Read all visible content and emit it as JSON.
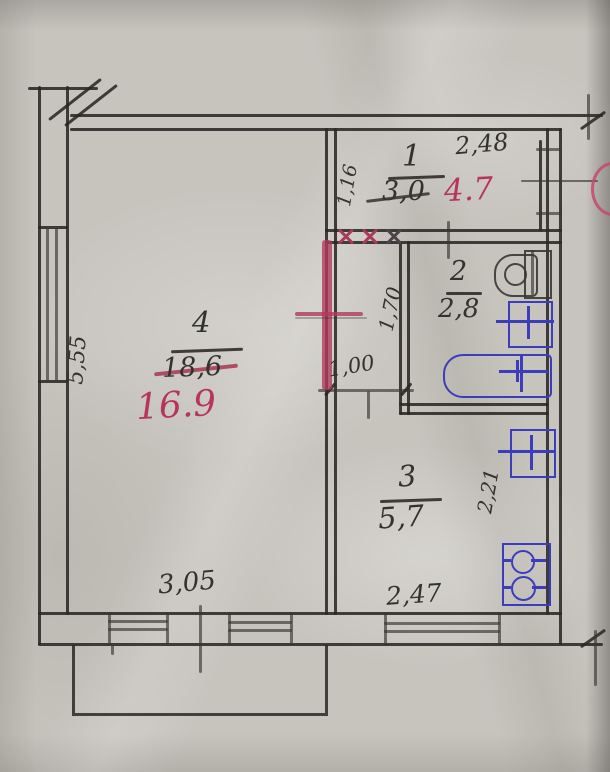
{
  "plan": {
    "title": "apartment-floor-plan-scan",
    "rooms": [
      {
        "number": "1",
        "area_old": "3,0",
        "area_new": "4.7"
      },
      {
        "number": "2",
        "area": "2,8"
      },
      {
        "number": "3",
        "area": "5,7"
      },
      {
        "number": "4",
        "area_old": "18,6",
        "area_new": "16.9"
      }
    ],
    "dimensions": {
      "room1_width": "2,48",
      "room1_depth": "1,16",
      "hall_length": "1,70",
      "hall_width": "1,00",
      "kitchen_depth": "2,21",
      "kitchen_width": "2,47",
      "room4_window": "3,05",
      "room4_depth": "5,55"
    },
    "fixtures": {
      "toilet": "toilet-icon",
      "washbasin": "washbasin-icon",
      "bathtub": "bathtub-icon",
      "kitchen_sink": "kitchen-sink-icon",
      "stove": "stove-icon"
    },
    "colors": {
      "paper": "#c7c4be",
      "pencil": "#2e2c29",
      "red_annotation": "#b8355a",
      "blue_fixture": "#3c3dbb"
    }
  }
}
